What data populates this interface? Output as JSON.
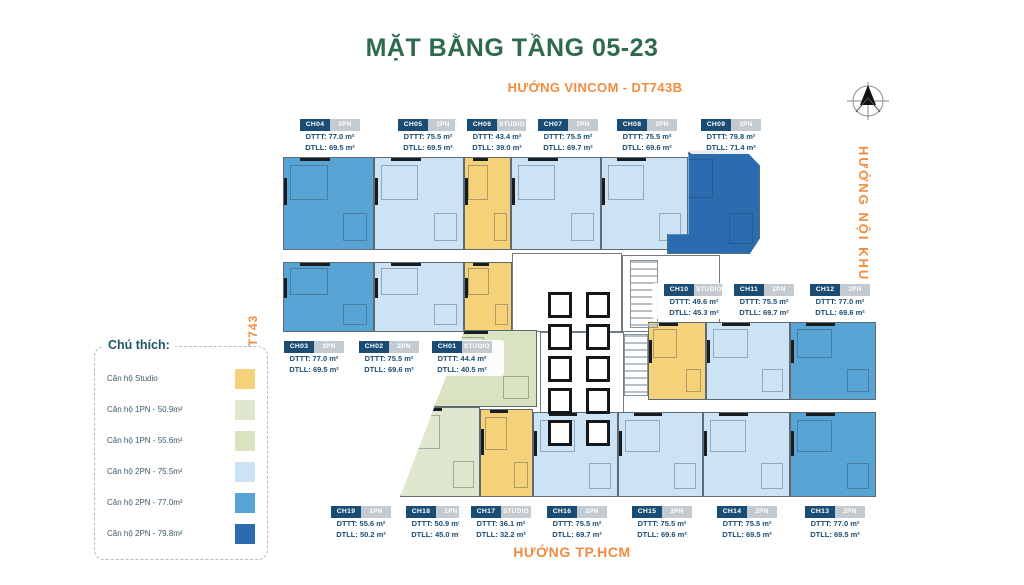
{
  "title": "MẶT BẰNG TẦNG 05-23",
  "directions": {
    "top": "HƯỚNG VINCOM - DT743B",
    "right": "HƯỚNG NỘI KHU",
    "left": "HƯỚNG DT743",
    "bottom": "HƯỚNG TP.HCM"
  },
  "colors": {
    "title_green": "#2D6A4E",
    "direction_orange": "#F28B3D",
    "label_navy": "#1B4D74",
    "label_gray": "#C3CBD1",
    "studio_yellow": "#F5D27A",
    "pn1_green_509": "#DFE8CE",
    "pn1_green_556": "#D9E3C1",
    "pn2_blue_755": "#CBE3F4",
    "pn2_blue_770": "#58A4D5",
    "pn2_blue_798": "#2B6CB0"
  },
  "legend": {
    "title": "Chú thích:",
    "items": [
      {
        "label": "Căn hộ Studio",
        "color": "#F5D27A"
      },
      {
        "label": "Căn hộ 1PN - 50.9m²",
        "color": "#DFE8CE"
      },
      {
        "label": "Căn hộ 1PN - 55.6m²",
        "color": "#D9E3C1"
      },
      {
        "label": "Căn hộ 2PN - 75.5m²",
        "color": "#CBE3F4"
      },
      {
        "label": "Căn hộ 2PN - 77.0m²",
        "color": "#58A4D5"
      },
      {
        "label": "Căn hộ 2PN - 79.8m²",
        "color": "#2B6CB0"
      }
    ]
  },
  "units": [
    {
      "code": "CH04",
      "type": "2PN",
      "dtt": "DTTT: 77.0 m²",
      "dtl": "DTLL: 69.5 m²",
      "cx": 330,
      "y": 118
    },
    {
      "code": "CH05",
      "type": "2PN",
      "dtt": "DTTT: 75.5 m²",
      "dtl": "DTLL: 69.5 m²",
      "cx": 428,
      "y": 118
    },
    {
      "code": "CH06",
      "type": "STUDIO",
      "dtt": "DTTT: 43.4 m²",
      "dtl": "DTLL: 39.0 m²",
      "cx": 497,
      "y": 118
    },
    {
      "code": "CH07",
      "type": "2PN",
      "dtt": "DTTT: 75.5 m²",
      "dtl": "DTLL: 69.7 m²",
      "cx": 568,
      "y": 118
    },
    {
      "code": "CH08",
      "type": "2PN",
      "dtt": "DTTT: 75.5 m²",
      "dtl": "DTLL: 69.6 m²",
      "cx": 647,
      "y": 118
    },
    {
      "code": "CH09",
      "type": "2PN",
      "dtt": "DTTT: 79.8 m²",
      "dtl": "DTLL: 71.4 m²",
      "cx": 731,
      "y": 118
    },
    {
      "code": "CH10",
      "type": "STUDIO",
      "dtt": "DTTT: 49.6 m²",
      "dtl": "DTLL: 45.3 m²",
      "cx": 694,
      "y": 283
    },
    {
      "code": "CH11",
      "type": "2PN",
      "dtt": "DTTT: 75.5 m²",
      "dtl": "DTLL: 69.7 m²",
      "cx": 764,
      "y": 283
    },
    {
      "code": "CH12",
      "type": "2PN",
      "dtt": "DTTT: 77.0 m²",
      "dtl": "DTLL: 69.6 m²",
      "cx": 840,
      "y": 283
    },
    {
      "code": "CH03",
      "type": "2PN",
      "dtt": "DTTT: 77.0 m²",
      "dtl": "DTLL: 69.5 m²",
      "cx": 314,
      "y": 340
    },
    {
      "code": "CH02",
      "type": "2PN",
      "dtt": "DTTT: 75.5 m²",
      "dtl": "DTLL: 69.6 m²",
      "cx": 389,
      "y": 340
    },
    {
      "code": "CH01",
      "type": "STUDIO",
      "dtt": "DTTT: 44.4 m²",
      "dtl": "DTLL: 40.5 m²",
      "cx": 462,
      "y": 340
    },
    {
      "code": "CH19",
      "type": "1PN",
      "dtt": "DTTT: 55.6 m²",
      "dtl": "DTLL: 50.2 m²",
      "cx": 361,
      "y": 505
    },
    {
      "code": "CH18",
      "type": "1PN",
      "dtt": "DTTT: 50.9 m²",
      "dtl": "DTLL: 45.0 m²",
      "cx": 436,
      "y": 505
    },
    {
      "code": "CH17",
      "type": "STUDIO",
      "dtt": "DTTT: 36.1 m²",
      "dtl": "DTLL: 32.2 m²",
      "cx": 501,
      "y": 505
    },
    {
      "code": "CH16",
      "type": "2PN",
      "dtt": "DTTT: 75.5 m²",
      "dtl": "DTLL: 69.7 m²",
      "cx": 577,
      "y": 505
    },
    {
      "code": "CH15",
      "type": "2PN",
      "dtt": "DTTT: 75.5 m²",
      "dtl": "DTLL: 69.6 m²",
      "cx": 662,
      "y": 505
    },
    {
      "code": "CH14",
      "type": "2PN",
      "dtt": "DTTT: 75.5 m²",
      "dtl": "DTLL: 69.5 m²",
      "cx": 747,
      "y": 505
    },
    {
      "code": "CH13",
      "type": "2PN",
      "dtt": "DTTT: 77.0 m²",
      "dtl": "DTLL: 69.5 m²",
      "cx": 835,
      "y": 505
    }
  ],
  "floor_plan": {
    "blocks": [
      {
        "n": "unit-ch04",
        "x": 283,
        "y": 157,
        "w": 91,
        "h": 93,
        "c": "#58A4D5",
        "u": 1
      },
      {
        "n": "unit-ch05",
        "x": 374,
        "y": 157,
        "w": 90,
        "h": 93,
        "c": "#CBE3F4",
        "u": 1
      },
      {
        "n": "unit-ch06",
        "x": 464,
        "y": 157,
        "w": 47,
        "h": 93,
        "c": "#F5D27A",
        "u": 1
      },
      {
        "n": "unit-ch07",
        "x": 511,
        "y": 157,
        "w": 90,
        "h": 93,
        "c": "#CBE3F4",
        "u": 1
      },
      {
        "n": "unit-ch08",
        "x": 601,
        "y": 157,
        "w": 87,
        "h": 93,
        "c": "#CBE3F4",
        "u": 1
      },
      {
        "n": "core-upper",
        "x": 512,
        "y": 253,
        "w": 110,
        "h": 79,
        "c": "#FFFFFF",
        "core": 1
      },
      {
        "n": "core-stair",
        "x": 622,
        "y": 255,
        "w": 98,
        "h": 77,
        "c": "#FFFFFF",
        "core": 1
      },
      {
        "n": "unit-ch09",
        "x": 667,
        "y": 150,
        "w": 93,
        "h": 104,
        "c": "#2B6CB0",
        "u": 1,
        "clip": "polygon(23% 0, 84% 0, 100% 15%, 100% 85%, 89% 100%, 0 100%, 0 81%, 23% 81%)"
      },
      {
        "n": "unit-ch03",
        "x": 283,
        "y": 262,
        "w": 91,
        "h": 70,
        "c": "#58A4D5",
        "u": 1
      },
      {
        "n": "unit-ch02",
        "x": 374,
        "y": 262,
        "w": 90,
        "h": 70,
        "c": "#CBE3F4",
        "u": 1
      },
      {
        "n": "unit-ch01",
        "x": 464,
        "y": 262,
        "w": 48,
        "h": 70,
        "c": "#F5D27A",
        "u": 1
      },
      {
        "n": "core-lift",
        "x": 540,
        "y": 332,
        "w": 84,
        "h": 133,
        "c": "#FFFFFF",
        "core": 1
      },
      {
        "n": "unit-ch19",
        "x": 434,
        "y": 330,
        "w": 103,
        "h": 77,
        "c": "#D9E3C1",
        "u": 1,
        "clip": "polygon(30% 0, 100% 0, 100% 100%, 0 100%)"
      },
      {
        "n": "unit-ch18",
        "x": 400,
        "y": 407,
        "w": 80,
        "h": 90,
        "c": "#DFE8CE",
        "u": 1,
        "clip": "polygon(43% 0, 100% 0, 100% 100%, 0 100%)"
      },
      {
        "n": "unit-ch17",
        "x": 480,
        "y": 409,
        "w": 53,
        "h": 88,
        "c": "#F5D27A",
        "u": 1
      },
      {
        "n": "unit-ch10",
        "x": 648,
        "y": 322,
        "w": 58,
        "h": 78,
        "c": "#F5D27A",
        "u": 1
      },
      {
        "n": "unit-ch11",
        "x": 706,
        "y": 322,
        "w": 84,
        "h": 78,
        "c": "#CBE3F4",
        "u": 1
      },
      {
        "n": "unit-ch12",
        "x": 790,
        "y": 322,
        "w": 86,
        "h": 78,
        "c": "#58A4D5",
        "u": 1
      },
      {
        "n": "unit-ch16",
        "x": 533,
        "y": 412,
        "w": 85,
        "h": 85,
        "c": "#CBE3F4",
        "u": 1
      },
      {
        "n": "unit-ch15",
        "x": 618,
        "y": 412,
        "w": 85,
        "h": 85,
        "c": "#CBE3F4",
        "u": 1
      },
      {
        "n": "unit-ch14",
        "x": 703,
        "y": 412,
        "w": 87,
        "h": 85,
        "c": "#CBE3F4",
        "u": 1
      },
      {
        "n": "unit-ch13",
        "x": 790,
        "y": 412,
        "w": 86,
        "h": 85,
        "c": "#58A4D5",
        "u": 1
      }
    ],
    "lifts": [
      [
        548,
        292
      ],
      [
        586,
        292
      ],
      [
        548,
        324
      ],
      [
        586,
        324
      ],
      [
        548,
        356
      ],
      [
        586,
        356
      ],
      [
        548,
        388
      ],
      [
        586,
        388
      ],
      [
        548,
        420
      ],
      [
        586,
        420
      ]
    ],
    "stairs": [
      {
        "x": 630,
        "y": 260,
        "w": 26,
        "h": 66
      },
      {
        "x": 624,
        "y": 334,
        "w": 22,
        "h": 60
      }
    ]
  }
}
